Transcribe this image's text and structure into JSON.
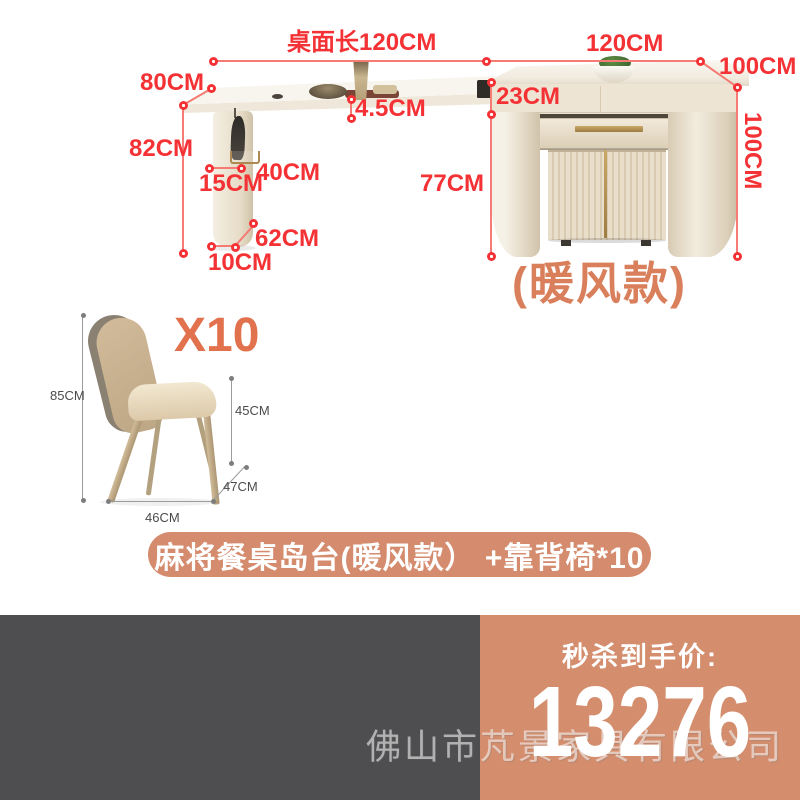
{
  "dims": {
    "table_length": "桌面长120CM",
    "island_width": "120CM",
    "island_depth": "100CM",
    "island_height": "100CM",
    "table_depth": "80CM",
    "table_height": "82CM",
    "leg_offset": "15CM",
    "leg_width": "40CM",
    "leg_depth": "62CM",
    "leg_thickness": "10CM",
    "top_thickness": "4.5CM",
    "drawer_height": "23CM",
    "under_clearance": "77CM"
  },
  "variant_label": "(暖风款)",
  "chair_dims": {
    "quantity": "X10",
    "height": "85CM",
    "seat_height": "45CM",
    "seat_depth": "47CM",
    "width": "46CM"
  },
  "banner_text": "麻将餐桌岛台(暖风款） +靠背椅*10",
  "price_label": "秒杀到手价:",
  "price_value": "13276",
  "watermark_text": "佛山市芃景家具有限公司",
  "colors": {
    "dimension_red": "#f43134",
    "dimension_line_red": "#f57b74",
    "variant_orange": "#d97f5b",
    "quantity_orange": "#e2714d",
    "banner_bg": "#d58b6d",
    "price_panel_bg": "#d48e6e",
    "left_panel_bg": "#4e4e50",
    "gold_accent": "#b28e55",
    "cabinet_cream": "#ece2d1"
  }
}
